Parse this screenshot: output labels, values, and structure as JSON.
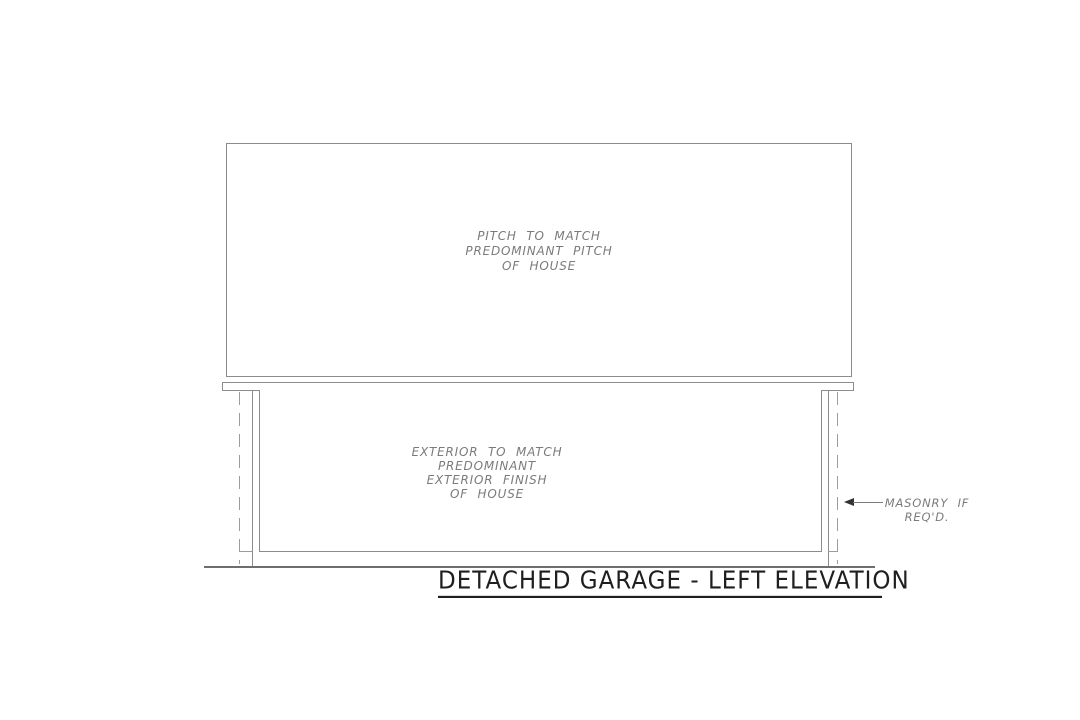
{
  "drawing": {
    "title": "DETACHED GARAGE - LEFT ELEVATION",
    "roof_note_lines": [
      "PITCH TO MATCH",
      "PREDOMINANT PITCH",
      "OF HOUSE"
    ],
    "wall_note_lines": [
      "EXTERIOR TO MATCH",
      "PREDOMINANT",
      "EXTERIOR FINISH",
      "OF HOUSE"
    ],
    "masonry_note_lines": [
      "MASONRY IF",
      "REQ'D."
    ]
  },
  "colors": {
    "line-gray": "#8c8c8c",
    "dash-gray": "#9c9c9c",
    "note-text": "#7b7b7b",
    "title-ink": "#1f1f1f",
    "ground-gray": "#6e6e6e",
    "arrow-ink": "#333333",
    "paper": "#ffffff"
  }
}
